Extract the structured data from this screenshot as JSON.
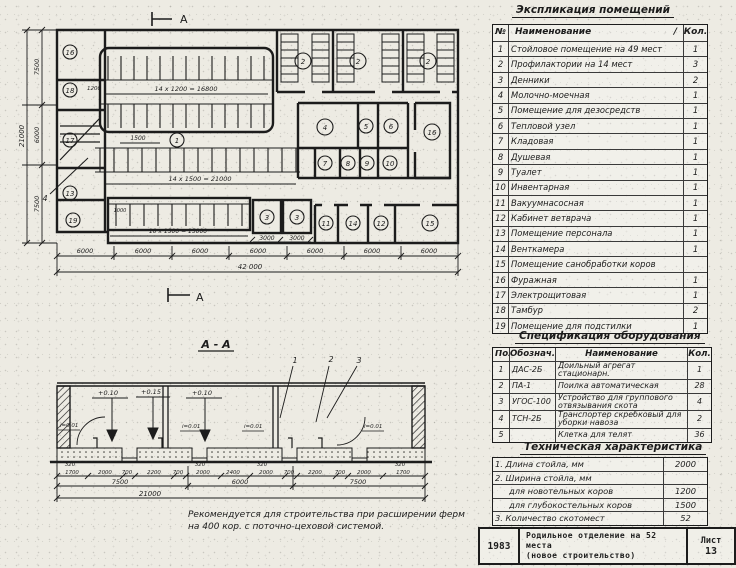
{
  "plan": {
    "marker_top": "А",
    "marker_bottom": "А",
    "leader": "4",
    "rooms": {
      "k1": "1",
      "k2a": "2",
      "k2b": "2",
      "k2c": "2",
      "k3a": "3",
      "k3b": "3",
      "k4": "4",
      "k5": "5",
      "k6": "6",
      "k7": "7",
      "k8": "8",
      "k9": "9",
      "k10": "10",
      "k11": "11",
      "k12": "12",
      "k13": "13",
      "k14": "14",
      "k15": "15",
      "k16a": "16",
      "k16b": "16",
      "k17": "17",
      "k18": "18",
      "k19": "19"
    },
    "dims": {
      "stall_top_count": "14 x 1200 = 16800",
      "stall_mid_count": "14 x 1500 = 21000",
      "stall_low_count": "10 x 1500 = 15000",
      "w1200": "1200",
      "w1500": "1500",
      "w1000": "1000",
      "den1": "3000",
      "den2": "3000",
      "bay": [
        "6000",
        "6000",
        "6000",
        "6000",
        "6000",
        "6000",
        "6000"
      ],
      "total_len": "42 000",
      "side": [
        "7500",
        "6000",
        "7500"
      ],
      "total_wid": "21000"
    }
  },
  "section": {
    "title": "А - А",
    "elev": [
      "+0.10",
      "+0.15",
      "+0.10"
    ],
    "slope": [
      "i=0.01",
      "i=0.01",
      "i=0.01",
      "i=0.01"
    ],
    "callout": [
      "1",
      "2",
      "3"
    ],
    "small": [
      "320",
      "320",
      "320",
      "320"
    ],
    "row1": [
      "1700",
      "2000",
      "700",
      "2200",
      "700",
      "2000",
      "2400",
      "2000",
      "700",
      "2200",
      "700",
      "2000",
      "1700"
    ],
    "row2": [
      "7500",
      "6000",
      "7500"
    ],
    "total": "21000"
  },
  "note": {
    "line1": "Рекомендуется для строительства при расширении ферм",
    "line2": "на 400 кор. с поточно-цеховой системой."
  },
  "explication": {
    "title": "Экспликация помещений",
    "col_num": "№",
    "col_name": "Наименование",
    "col_mark": "/",
    "col_qty": "Кол.",
    "rows": [
      {
        "n": "1",
        "name": "Стойловое помещение на 49 мест",
        "qty": "1"
      },
      {
        "n": "2",
        "name": "Профилактории на 14 мест",
        "qty": "3"
      },
      {
        "n": "3",
        "name": "Денники",
        "qty": "2"
      },
      {
        "n": "4",
        "name": "Молочно-моечная",
        "qty": "1"
      },
      {
        "n": "5",
        "name": "Помещение для дезосредств",
        "qty": "1"
      },
      {
        "n": "6",
        "name": "Тепловой узел",
        "qty": "1"
      },
      {
        "n": "7",
        "name": "Кладовая",
        "qty": "1"
      },
      {
        "n": "8",
        "name": "Душевая",
        "qty": "1"
      },
      {
        "n": "9",
        "name": "Туалет",
        "qty": "1"
      },
      {
        "n": "10",
        "name": "Инвентарная",
        "qty": "1"
      },
      {
        "n": "11",
        "name": "Вакуумнасосная",
        "qty": "1"
      },
      {
        "n": "12",
        "name": "Кабинет ветврача",
        "qty": "1"
      },
      {
        "n": "13",
        "name": "Помещение персонала",
        "qty": "1"
      },
      {
        "n": "14",
        "name": "Венткамера",
        "qty": "1"
      },
      {
        "n": "15",
        "name": "Помещение санобработки коров",
        "qty": ""
      },
      {
        "n": "16",
        "name": "Фуражная",
        "qty": "1"
      },
      {
        "n": "17",
        "name": "Электрощитовая",
        "qty": "1"
      },
      {
        "n": "18",
        "name": "Тамбур",
        "qty": "2"
      },
      {
        "n": "19",
        "name": "Помещение для подстилки",
        "qty": "1"
      }
    ]
  },
  "spec": {
    "title": "Спецификация оборудования",
    "col_pos": "Поз.",
    "col_mark": "Обознач.",
    "col_name": "Наименование",
    "col_qty": "Кол.",
    "rows": [
      {
        "pos": "1",
        "mark": "ДАС-2Б",
        "name": "Доильный агрегат стационарн.",
        "qty": "1"
      },
      {
        "pos": "2",
        "mark": "ПА-1",
        "name": "Поилка автоматическая",
        "qty": "28"
      },
      {
        "pos": "3",
        "mark": "УГОС-100",
        "name": "Устройство для группового отвязывания скота",
        "qty": "4"
      },
      {
        "pos": "4",
        "mark": "ТСН-2Б",
        "name": "Транспортер скребковый для уборки навоза",
        "qty": "2"
      },
      {
        "pos": "5",
        "mark": "",
        "name": "Клетка для телят",
        "qty": "36"
      }
    ]
  },
  "tech": {
    "title": "Техническая характеристика",
    "r1": {
      "label": "1. Длина стойла, мм",
      "value": "2000"
    },
    "r2": {
      "label": "2. Ширина стойла, мм",
      "value": ""
    },
    "r2a": {
      "label": "для новотельных коров",
      "value": "1200"
    },
    "r2b": {
      "label": "для глубокостельных коров",
      "value": "1500"
    },
    "r3": {
      "label": "3. Количество скотомест",
      "value": "52"
    }
  },
  "title_block": {
    "year": "1983",
    "object_line1": "Родильное отделение на 52 места",
    "object_line2": "(новое строительство)",
    "sheet_label": "Лист",
    "sheet_no": "13"
  }
}
